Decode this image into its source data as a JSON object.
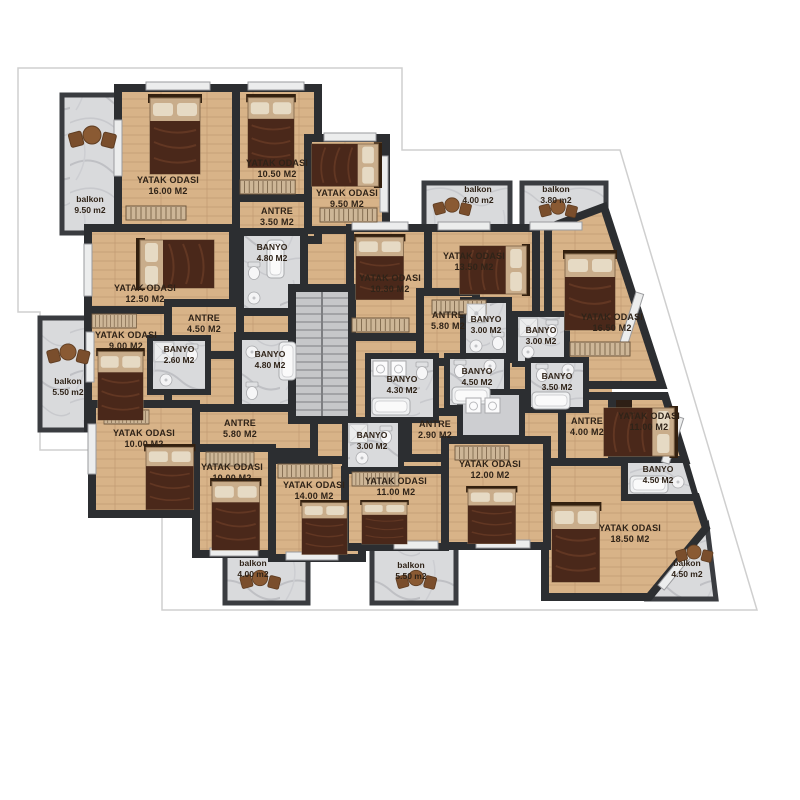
{
  "plan_title": "apartment floor plan",
  "colors": {
    "wall": "#2c2e31",
    "wood_floor": "#d8b388",
    "tile_floor": "#d9dadc",
    "stair_floor": "#c6c7c9",
    "bed_blanket": "#4a281a",
    "label_text": "#2f2318",
    "parcel_outline": "#cfcfcf",
    "background": "#ffffff"
  },
  "rooms": [
    {
      "name": "balkon",
      "area": "9.50 m2"
    },
    {
      "name": "YATAK ODASI",
      "area": "16.00 M2"
    },
    {
      "name": "YATAK ODASI",
      "area": "10.50 M2"
    },
    {
      "name": "ANTRE",
      "area": "3.50 M2"
    },
    {
      "name": "YATAK ODASI",
      "area": "9.50 M2"
    },
    {
      "name": "BANYO",
      "area": "4.80 M2"
    },
    {
      "name": "YATAK ODASI",
      "area": "12.50 M2"
    },
    {
      "name": "ANTRE",
      "area": "4.50 M2"
    },
    {
      "name": "YATAK ODASI",
      "area": "9.00 M2"
    },
    {
      "name": "BANYO",
      "area": "2.60 M2"
    },
    {
      "name": "BANYO",
      "area": "4.80 M2"
    },
    {
      "name": "balkon",
      "area": "5.50 m2"
    },
    {
      "name": "ANTRE",
      "area": "5.80 M2"
    },
    {
      "name": "YATAK ODASI",
      "area": "10.00 M2"
    },
    {
      "name": "YATAK ODASI",
      "area": "10.00 M2"
    },
    {
      "name": "YATAK ODASI",
      "area": "14.00 M2"
    },
    {
      "name": "balkon",
      "area": "4.00 m2"
    },
    {
      "name": "balkon",
      "area": "5.50 m2"
    },
    {
      "name": "YATAK ODASI",
      "area": "10.30 M2"
    },
    {
      "name": "YATAK ODASI",
      "area": "13.50 M2"
    },
    {
      "name": "ANTRE",
      "area": "5.80 M2"
    },
    {
      "name": "BANYO",
      "area": "3.00 M2"
    },
    {
      "name": "BANYO",
      "area": "4.30 M2"
    },
    {
      "name": "BANYO",
      "area": "4.50 M2"
    },
    {
      "name": "BANYO",
      "area": "3.00 M2"
    },
    {
      "name": "BANYO",
      "area": "3.50 M2"
    },
    {
      "name": "YATAK ODASI",
      "area": "16.50 M2"
    },
    {
      "name": "ANTRE",
      "area": "4.00 M2"
    },
    {
      "name": "YATAK ODASI",
      "area": "11.00 M2"
    },
    {
      "name": "BANYO",
      "area": "4.50 M2"
    },
    {
      "name": "YATAK ODASI",
      "area": "18.50 M2"
    },
    {
      "name": "balkon",
      "area": "4.50 m2"
    },
    {
      "name": "BANYO",
      "area": "3.00 M2"
    },
    {
      "name": "ANTRE",
      "area": "2.90 M2"
    },
    {
      "name": "YATAK ODASI",
      "area": "11.00 M2"
    },
    {
      "name": "YATAK ODASI",
      "area": "12.00 M2"
    },
    {
      "name": "balkon",
      "area": "4.00 m2"
    },
    {
      "name": "balkon",
      "area": "3.80 m2"
    }
  ]
}
